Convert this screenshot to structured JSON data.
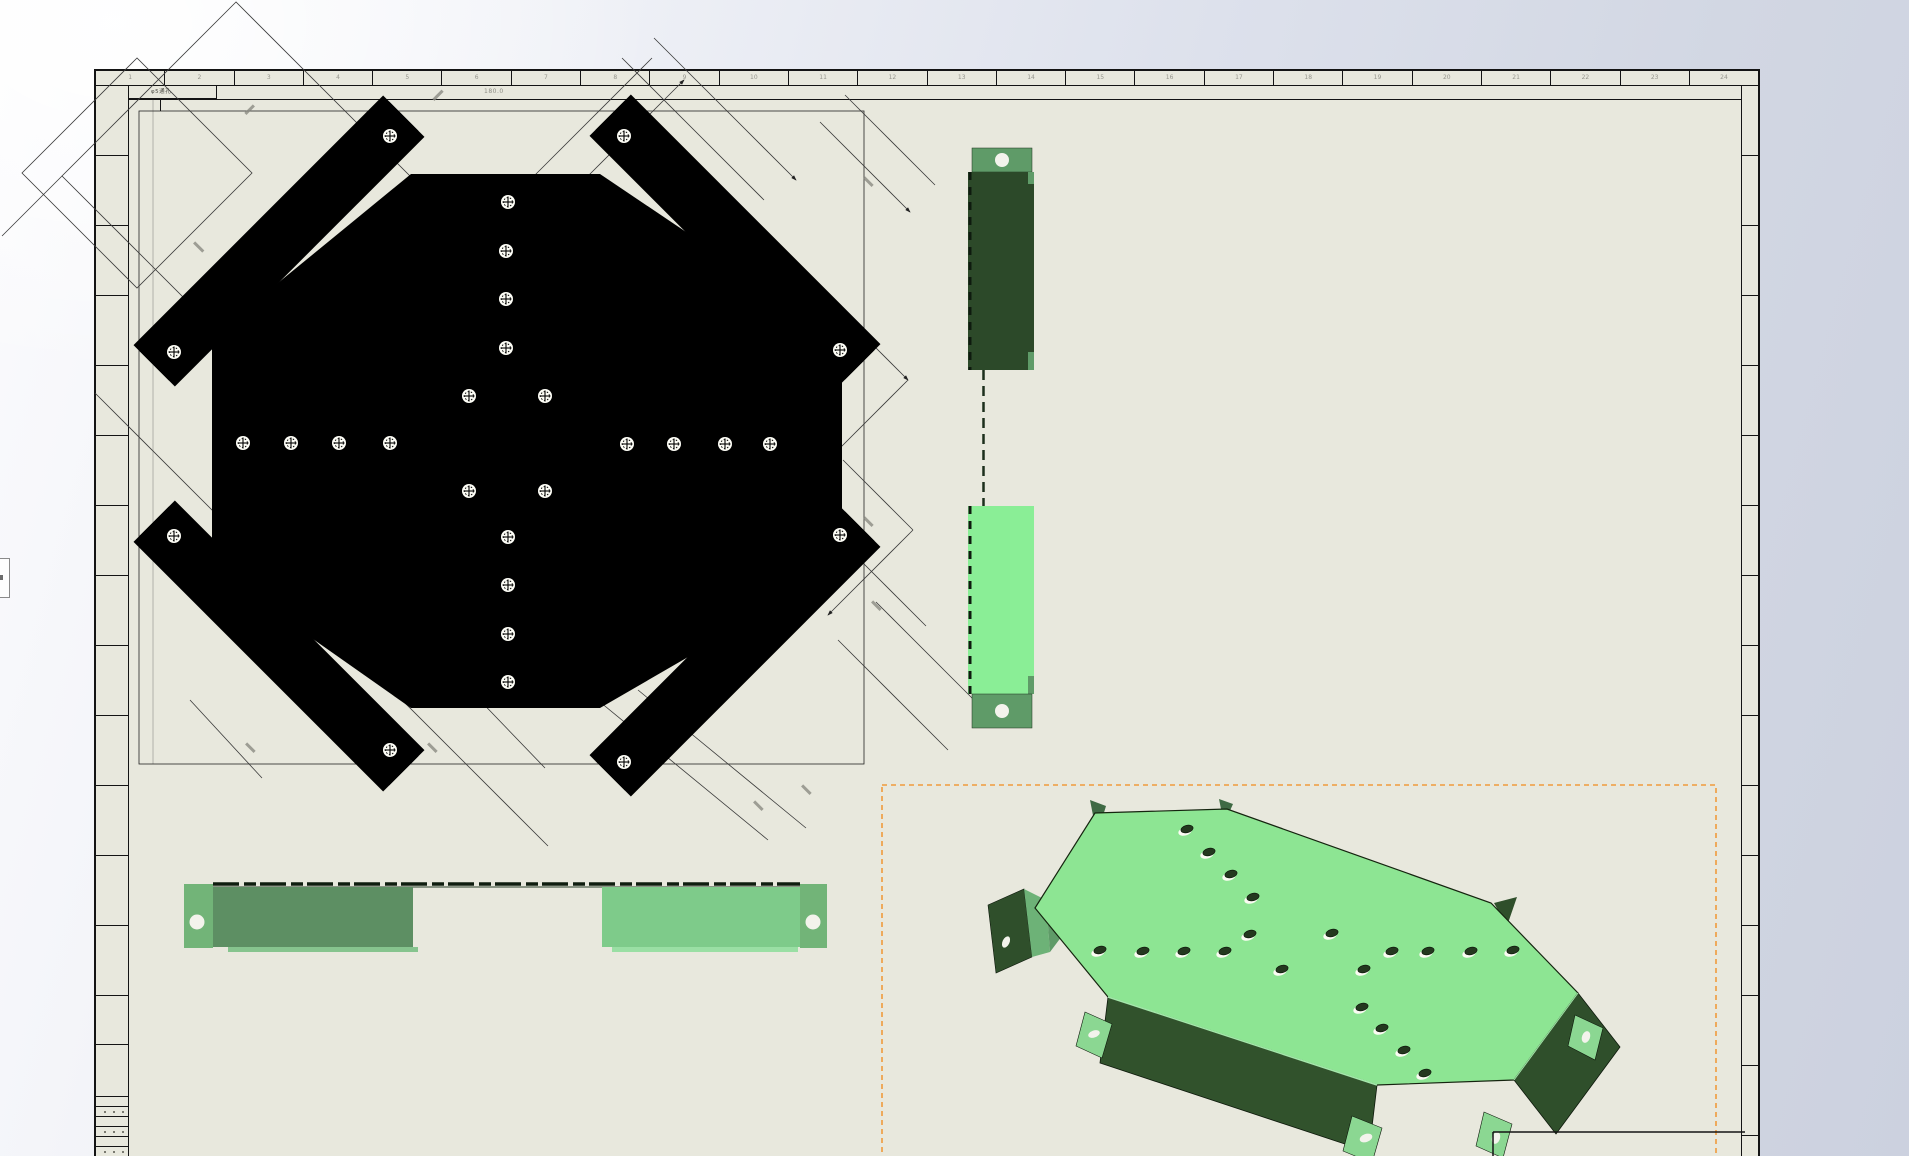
{
  "sheet": {
    "zone_numbers": [
      "1",
      "2",
      "3",
      "4",
      "5",
      "6",
      "7",
      "8",
      "9",
      "10",
      "11",
      "12",
      "13",
      "14",
      "15",
      "16",
      "17",
      "18",
      "19",
      "20",
      "21",
      "22",
      "23",
      "24"
    ],
    "hole_note": "φ5通孔",
    "top_dimension": "180.0"
  },
  "colors": {
    "paper": "#e8e8dd",
    "selection_orange": "#ef9a3c",
    "plate_black": "#000000",
    "green_dark": "#2c4929",
    "green_flange_dark": "#2f4f2b",
    "green_medium": "#5f9b68",
    "green_tab": "#72b478",
    "green_light": "#8aee96",
    "green_sage": "#5d8f63",
    "green_light2": "#7ecb8a",
    "green_face_3d": "#8de593"
  },
  "geometry": {
    "plate_holes": [
      [
        508,
        202
      ],
      [
        506,
        251
      ],
      [
        506,
        299
      ],
      [
        506,
        348
      ],
      [
        469,
        396
      ],
      [
        545,
        396
      ],
      [
        469,
        491
      ],
      [
        545,
        491
      ],
      [
        243,
        443
      ],
      [
        291,
        443
      ],
      [
        339,
        443
      ],
      [
        390,
        443
      ],
      [
        627,
        444
      ],
      [
        674,
        444
      ],
      [
        725,
        444
      ],
      [
        770,
        444
      ],
      [
        508,
        537
      ],
      [
        508,
        585
      ],
      [
        508,
        634
      ],
      [
        508,
        682
      ],
      [
        390,
        136
      ],
      [
        174,
        352
      ],
      [
        624,
        136
      ],
      [
        840,
        350
      ],
      [
        390,
        750
      ],
      [
        174,
        536
      ],
      [
        624,
        762
      ],
      [
        840,
        535
      ]
    ],
    "face_holes": [
      [
        1187,
        829
      ],
      [
        1209,
        852
      ],
      [
        1231,
        874
      ],
      [
        1253,
        897
      ],
      [
        1250,
        934
      ],
      [
        1332,
        933
      ],
      [
        1100,
        950
      ],
      [
        1143,
        951
      ],
      [
        1184,
        951
      ],
      [
        1225,
        951
      ],
      [
        1282,
        969
      ],
      [
        1364,
        969
      ],
      [
        1392,
        951
      ],
      [
        1428,
        951
      ],
      [
        1471,
        951
      ],
      [
        1513,
        950
      ],
      [
        1362,
        1007
      ],
      [
        1382,
        1028
      ],
      [
        1404,
        1050
      ],
      [
        1425,
        1073
      ]
    ]
  }
}
